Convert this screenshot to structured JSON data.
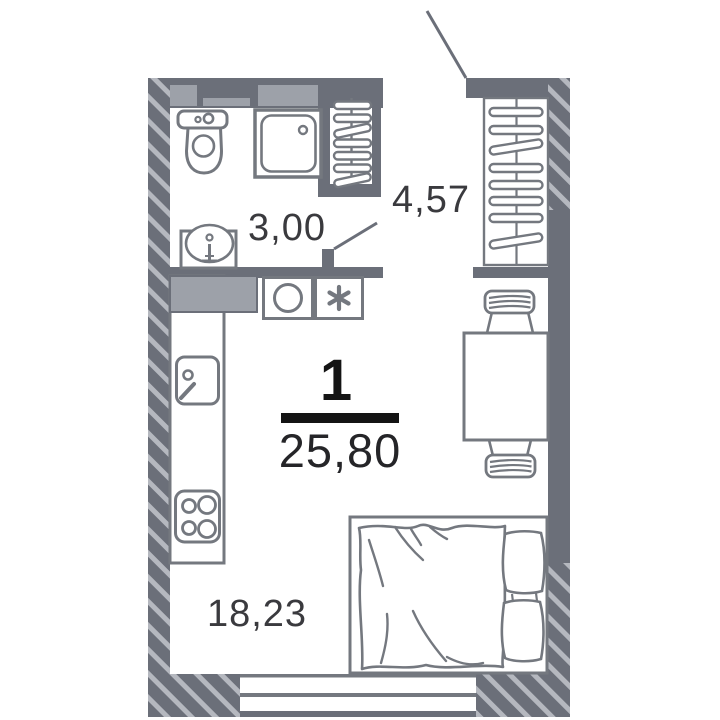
{
  "apartment": {
    "rooms_count": "1",
    "total_area": "25,80",
    "rooms": {
      "bathroom": {
        "name": "bathroom",
        "area": "3,00"
      },
      "hallway": {
        "name": "hallway",
        "area": "4,57"
      },
      "living": {
        "name": "living-room-kitchen",
        "area": "18,23"
      }
    },
    "icons": [
      "toilet-icon",
      "shower-icon",
      "washbasin-icon",
      "towel-radiator-icon",
      "wardrobe-icon",
      "washing-machine-icon",
      "fridge-icon",
      "kitchen-sink-icon",
      "stove-icon",
      "dining-table-icon",
      "chair-icon",
      "double-bed-icon",
      "entrance-door-icon",
      "bathroom-door-icon",
      "window-icon"
    ],
    "colors": {
      "wall": "#6b6f79",
      "hatch_stripe": "#b5b8bf",
      "vent": "#9da1a9",
      "furniture": "#74787f",
      "label": "#3a3a3e",
      "accent": "#141414",
      "background": "#ffffff"
    }
  }
}
